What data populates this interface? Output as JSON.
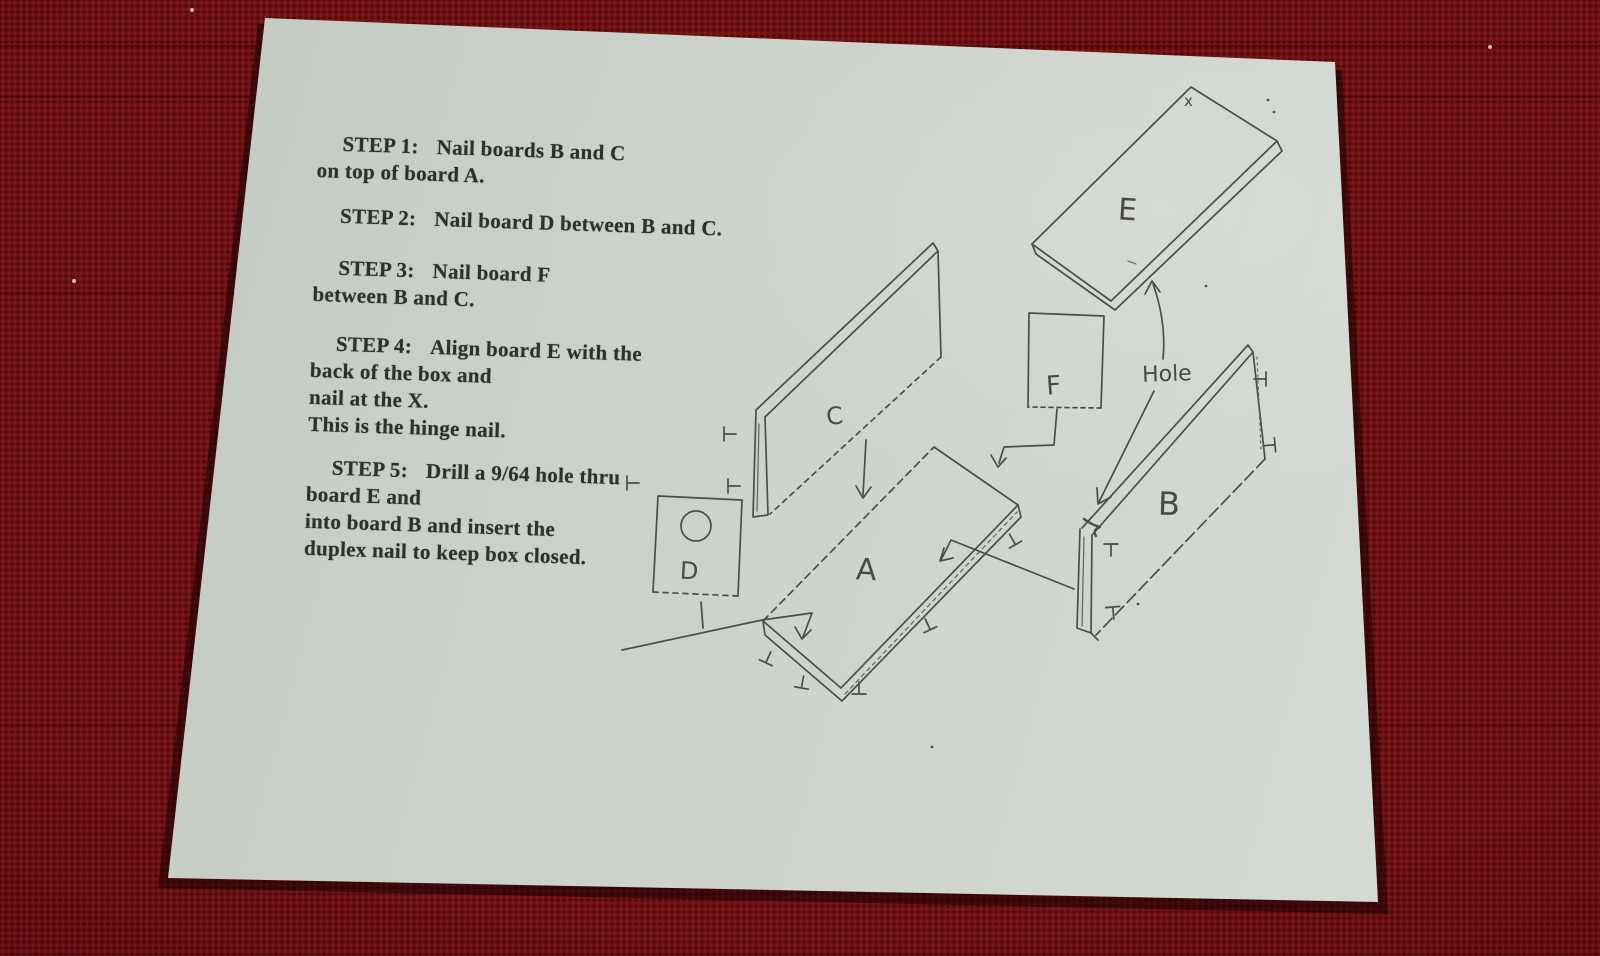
{
  "scene": {
    "fabric_color": "#701114",
    "paper_color": "#cdd4cc",
    "ink_color": "#2f2f2b",
    "sketch_color": "#4e4e46"
  },
  "sheet": {
    "steps": [
      {
        "label": "STEP 1:",
        "lines": [
          "Nail boards B and C",
          "on top of board A."
        ]
      },
      {
        "label": "STEP 2:",
        "lines": [
          "Nail board D between B and C."
        ]
      },
      {
        "label": "STEP 3:",
        "lines": [
          "Nail board F",
          "between B and C."
        ]
      },
      {
        "label": "STEP 4:",
        "lines": [
          "Align board E with the",
          "back of the box and",
          "nail at the X.",
          "This is the hinge nail."
        ]
      },
      {
        "label": "STEP 5:",
        "lines": [
          "Drill a 9/64 hole thru",
          "board E and",
          "into board B and insert the",
          "duplex nail to keep box closed."
        ]
      }
    ],
    "diagram": {
      "board_labels": {
        "a": "A",
        "b": "B",
        "c": "C",
        "d": "D",
        "e": "E",
        "f": "F"
      },
      "annotations": {
        "hole": "Hole",
        "x_mark": "x"
      }
    }
  }
}
